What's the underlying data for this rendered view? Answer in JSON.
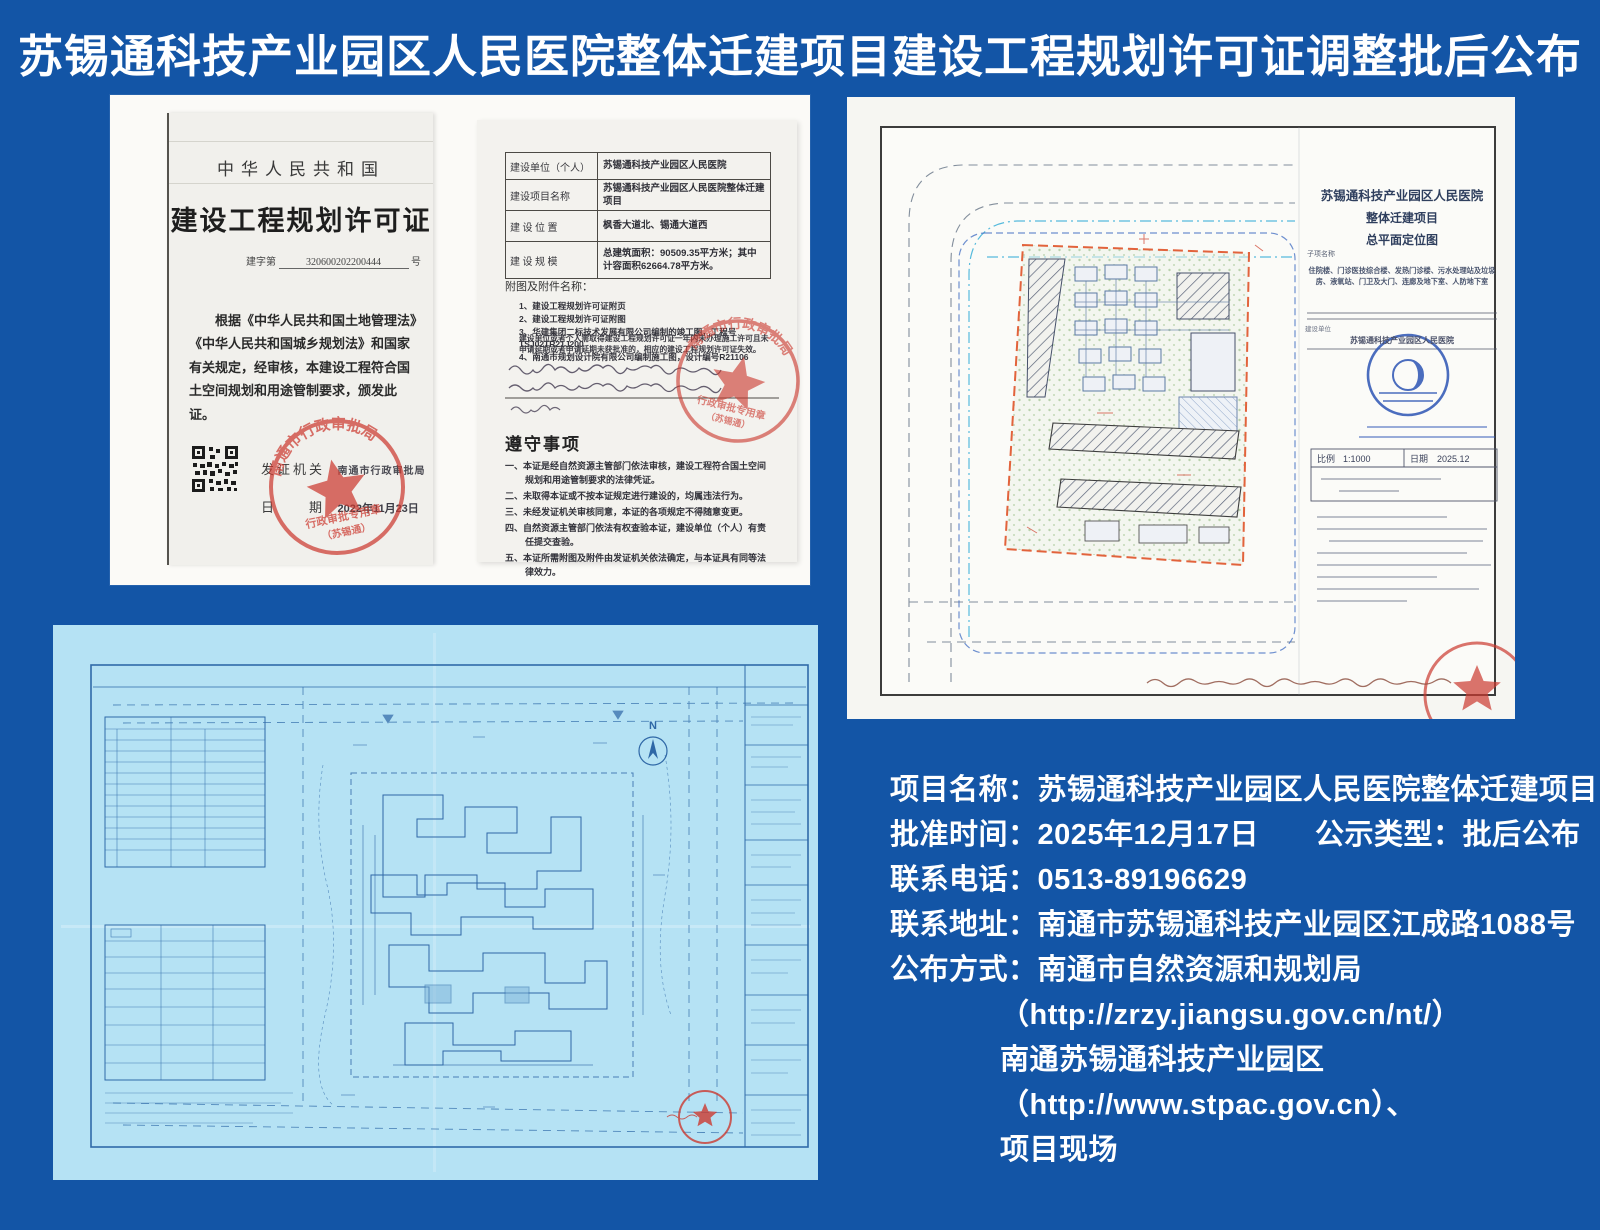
{
  "page": {
    "title": "苏锡通科技产业园区人民医院整体迁建项目建设工程规划许可证调整批后公布"
  },
  "permit_left": {
    "nation": "中华人民共和国",
    "doc_title": "建设工程规划许可证",
    "serial_prefix": "建字第",
    "serial_number": "320600202200444",
    "serial_suffix": "号",
    "body_text": "根据《中华人民共和国土地管理法》《中华人民共和国城乡规划法》和国家有关规定，经审核，本建设工程符合国土空间规划和用途管制要求，颁发此证。",
    "issuer_label": "发证机关",
    "issuer_value": "南通市行政审批局",
    "date_label": "日　　期",
    "date_value": "2022年11月23日",
    "stamp_arc_text": "南通市行政审批局",
    "stamp_line1": "行政审批专用章",
    "stamp_line2": "（苏锡通）"
  },
  "permit_right": {
    "rows": [
      {
        "label": "建设单位（个人）",
        "value": "苏锡通科技产业园区人民医院"
      },
      {
        "label": "建设项目名称",
        "value": "苏锡通科技产业园区人民医院整体迁建项目"
      },
      {
        "label": "建 设 位 置",
        "value": "枫香大道北、锡通大道西"
      },
      {
        "label": "建 设 规 模",
        "value": "总建筑面积：90509.35平方米；其中计容面积62664.78平方米。"
      }
    ],
    "attachments_label": "附图及附件名称：",
    "attachments": [
      "1、建设工程规划许可证附页",
      "2、建设工程规划许可证附图",
      "3、华建集团二标技术发展有限公司编制的竣工图，工程号TSJ02TR21J200",
      "4、南通市规划设计院有限公司编制施工图，设计编号R21106"
    ],
    "note": "建设单位或者个人需取得建设工程规划许可证一年内未办理施工许可且未申请延期或者申请延期未获批准的，相应的建设工程规划许可证失效。",
    "compliance_title": "遵守事项",
    "compliance_items": [
      "一、本证是经自然资源主管部门依法审核，建设工程符合国土空间规划和用途管制要求的法律凭证。",
      "二、未取得本证或不按本证规定进行建设的，均属违法行为。",
      "三、未经发证机关审核同意，本证的各项规定不得随意变更。",
      "四、自然资源主管部门依法有权查验本证，建设单位（个人）有责任提交查验。",
      "五、本证所需附图及附件由发证机关依法确定，与本证具有同等法律效力。"
    ]
  },
  "site_plan": {
    "title_line1": "苏锡通科技产业园区人民医院",
    "title_line2": "整体迁建项目",
    "title_line3": "总平面定位图",
    "subitem_label": "子项名称",
    "subitems": "住院楼、门诊医技综合楼、发热门诊楼、污水处理站及垃圾房、液氧站、门卫及大门、连廊及地下室、人防地下室",
    "client_label": "建设单位",
    "client_value": "苏锡通科技产业园区人民医院",
    "scale_label": "比例",
    "scale_value": "1:1000",
    "date_label": "日期",
    "date_value": "2025.12"
  },
  "blueprint": {
    "north_label": "N"
  },
  "info": {
    "rows": [
      {
        "label": "项目名称：",
        "value": "苏锡通科技产业园区人民医院整体迁建项目"
      },
      {
        "label": "批准时间：",
        "value": "2025年12月17日",
        "label2": "公示类型：",
        "value2": "批后公布"
      },
      {
        "label": "联系电话：",
        "value": "0513-89196629"
      },
      {
        "label": "联系地址：",
        "value": "南通市苏锡通科技产业园区江成路1088号"
      },
      {
        "label": "公布方式：",
        "value": "南通市自然资源和规划局"
      },
      {
        "value": "（http://zrzy.jiangsu.gov.cn/nt/）"
      },
      {
        "value": "南通苏锡通科技产业园区"
      },
      {
        "value": "（http://www.stpac.gov.cn）、"
      },
      {
        "value": "项目现场"
      }
    ]
  },
  "colors": {
    "background": "#1355a6",
    "stamp_red": "#cc3a30",
    "stamp_blue": "#2d55b5",
    "boundary_orange": "#e2633c",
    "blueprint_bg": "#b5e2f4",
    "blueprint_line": "#2f6aa8"
  }
}
